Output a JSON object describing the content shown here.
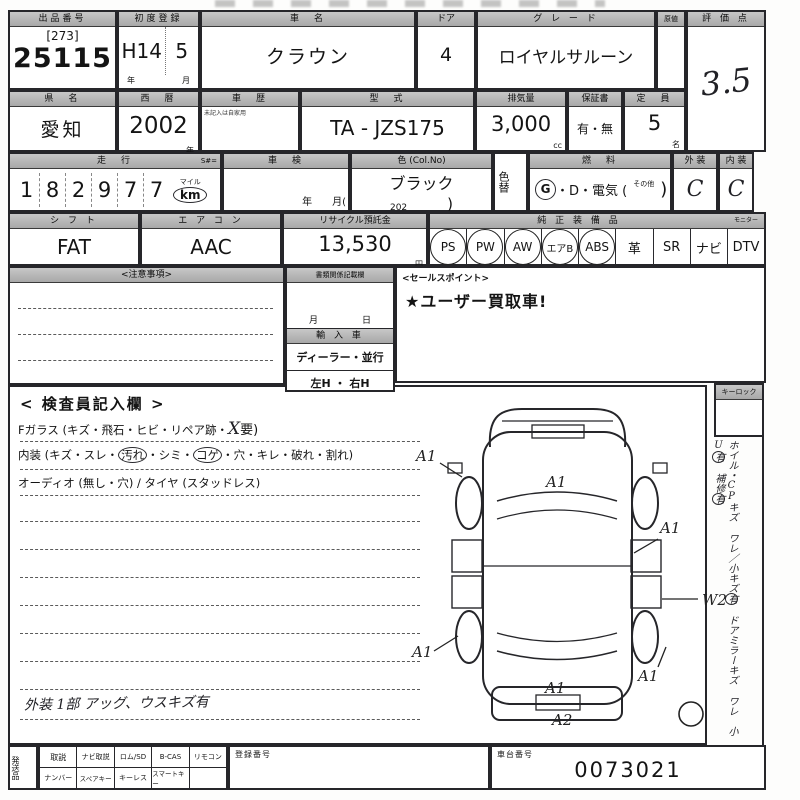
{
  "row1": {
    "lot": {
      "header": "出品番号",
      "bracket": "[273]",
      "number": "25115"
    },
    "first_reg": {
      "header": "初度登録",
      "era": "H14",
      "month": "5",
      "unit_year": "年",
      "unit_month": "月"
    },
    "car_name": {
      "header": "車　名",
      "value": "クラウン"
    },
    "door": {
      "header": "ドア",
      "value": "4"
    },
    "grade": {
      "header": "グ レ ー ド",
      "value": "ロイヤルサルーン"
    },
    "aux": {
      "header": "原値"
    },
    "score": {
      "header": "評 価 点",
      "value": "3.5"
    }
  },
  "row2": {
    "pref": {
      "header": "県　名",
      "value": "愛知"
    },
    "year": {
      "header": "西　暦",
      "value": "2002",
      "unit": "年"
    },
    "history": {
      "header": "車　歴",
      "note": "未記入は自家用"
    },
    "model": {
      "header": "型　式",
      "value": "TA - JZS175"
    },
    "displacement": {
      "header": "排気量",
      "value": "3,000",
      "unit": "cc"
    },
    "warranty": {
      "header": "保証書",
      "value": "有・無"
    },
    "capacity": {
      "header": "定　員",
      "value": "5",
      "unit": "名"
    }
  },
  "row3": {
    "mileage": {
      "header": "走　行",
      "header_right": "S#=",
      "digits": [
        "1",
        "8",
        "2",
        "9",
        "7",
        "7"
      ],
      "unit_small": "マイル",
      "unit": "km"
    },
    "shaken": {
      "header": "車　検",
      "unit": "年　　月("
    },
    "color": {
      "header": "色 (Col.No)",
      "value": "ブラック",
      "code": "202",
      "close": ")"
    },
    "color_change": {
      "header": "色替"
    },
    "fuel": {
      "header": "燃　料",
      "gas": "G",
      "rest": "・D・電気 (",
      "other": "その他",
      "close": ")"
    },
    "exterior": {
      "header": "外 装",
      "value": "C"
    },
    "interior": {
      "header": "内 装",
      "value": "C"
    }
  },
  "row4": {
    "shift": {
      "header": "シ フ ト",
      "value": "FAT"
    },
    "aircon": {
      "header": "エ ア コ ン",
      "value": "AAC"
    },
    "recycle": {
      "header": "リサイクル預託金",
      "value": "13,530",
      "unit": "円"
    },
    "equipment": {
      "header": "純 正 装 備 品",
      "header_right": "モニター",
      "items": [
        {
          "label": "PS",
          "circled": true
        },
        {
          "label": "PW",
          "circled": true
        },
        {
          "label": "AW",
          "circled": true
        },
        {
          "label": "エアB",
          "circled": true
        },
        {
          "label": "ABS",
          "circled": true
        },
        {
          "label": "革",
          "circled": false
        },
        {
          "label": "SR",
          "circled": false
        },
        {
          "label": "ナビ",
          "circled": false
        },
        {
          "label": "DTV",
          "circled": false
        }
      ]
    }
  },
  "middle": {
    "notes": {
      "header": "<注意事項>"
    },
    "docs": {
      "header": "書類関係記載欄",
      "month": "月",
      "day": "日"
    },
    "import_car": {
      "header": "輸 入 車",
      "dealer": "ディーラー・並行",
      "handle": "左H ・ 右H"
    },
    "sales": {
      "header": "<セールスポイント>",
      "value": "★ユーザー買取車!"
    }
  },
  "inspector": {
    "title": "< 検査員記入欄 >",
    "line1": {
      "pre": "Fガラス (キズ・飛石・ヒビ・リペア跡・",
      "hand": "X",
      "post": "要)"
    },
    "line2": {
      "seg1": "内装 (キズ・スレ・",
      "c1": "汚れ",
      "seg2": "・シミ・",
      "c2": "コゲ",
      "seg3": "・穴・キレ・破れ・割れ)"
    },
    "line3": "オーディオ (無し・穴) / タイヤ (スタッドレス)",
    "note": "外装 1部 アッグ、ウスキズ有"
  },
  "diagram": {
    "labels": [
      {
        "text": "A1"
      },
      {
        "text": "A1"
      },
      {
        "text": "A1"
      },
      {
        "text": "W2"
      },
      {
        "text": "A1"
      },
      {
        "text": "A1"
      },
      {
        "text": "A1"
      },
      {
        "text": "A2"
      }
    ]
  },
  "sidebar": {
    "keylock": "キーロック",
    "note": [
      {
        "t": "ホイル・CPキズ ワレ／"
      },
      {
        "t": "小キズ"
      },
      {
        "t": "有"
      },
      {
        "t": "　ドアミラーキズ ワレ"
      },
      {
        "t": "　小U"
      },
      {
        "t": "有"
      },
      {
        "t": "　補修"
      },
      {
        "t": "有"
      }
    ]
  },
  "bottom": {
    "shipping_label": "発送品",
    "row1": [
      "取説",
      "ナビ取説",
      "ロム/SD",
      "B-CAS",
      "リモコン"
    ],
    "row2": [
      "ナンバー",
      "スペアキー",
      "キーレス",
      "スマートキー"
    ],
    "reg": {
      "header": "登録番号"
    },
    "chassis": {
      "header": "車台番号",
      "value": "0073021"
    }
  }
}
